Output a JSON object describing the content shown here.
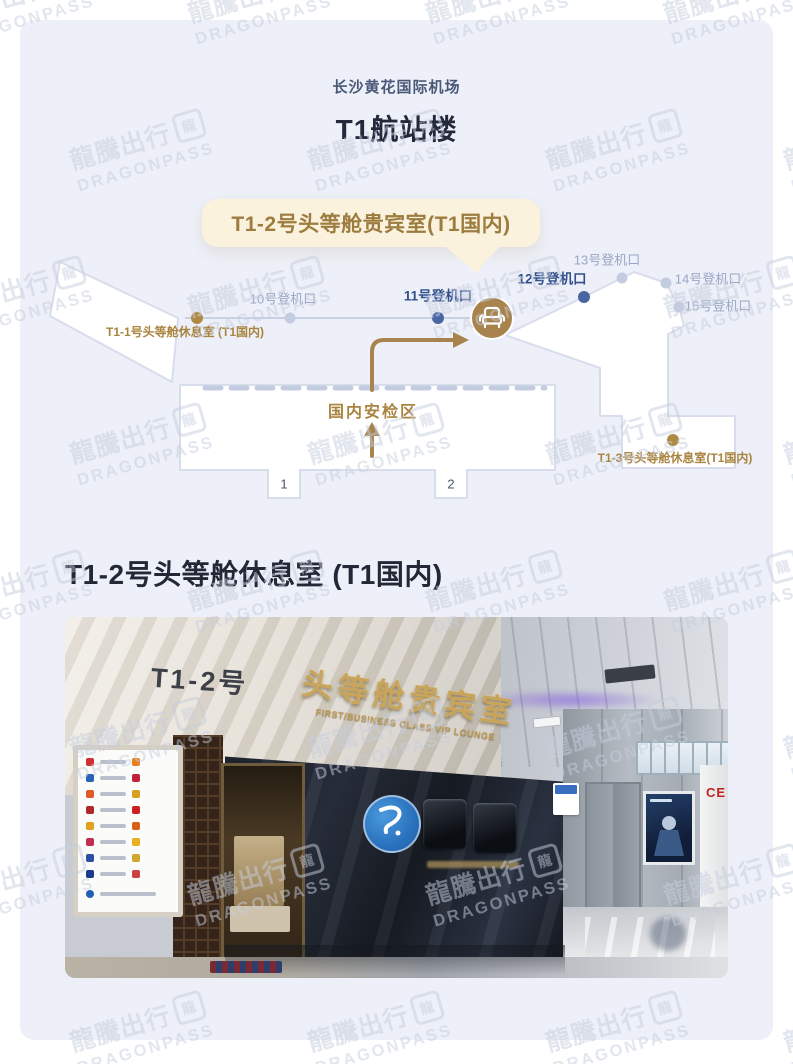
{
  "watermark": {
    "cn": "龍騰出行",
    "en": "DRAGONPASS",
    "logo_char": "龍"
  },
  "header": {
    "airport": "长沙黄花国际机场",
    "terminal": "T1航站楼"
  },
  "map": {
    "callout_label": "T1-2号头等舱贵宾室(T1国内)",
    "security_label": "国内安检区",
    "doors": [
      "1",
      "2"
    ],
    "gates": [
      {
        "label": "10号登机口",
        "state": "default"
      },
      {
        "label": "11号登机口",
        "state": "highlight"
      },
      {
        "label": "12号登机口",
        "state": "highlight"
      },
      {
        "label": "13号登机口",
        "state": "default"
      },
      {
        "label": "14号登机口",
        "state": "default"
      },
      {
        "label": "15号登机口",
        "state": "default"
      }
    ],
    "lounges": [
      {
        "label": "T1-1号头等舱休息室 (T1国内)"
      },
      {
        "label": "T1-3号头等舱休息室(T1国内)"
      }
    ],
    "colors": {
      "card_bg": "#EDF0F8",
      "terminal_fill": "#FFFFFF",
      "terminal_stroke": "#D8DDEB",
      "accent_gold": "#A8834E",
      "gold_text": "#A9843F",
      "gate_highlight_text": "#33508C",
      "gate_default_text": "#9AA6C6",
      "dot_highlight": "#4A66A0",
      "dot_default": "#C3CCE1",
      "callout_bg": "#FBF2DE",
      "callout_text": "#9C7C3F",
      "dashed_line": "#C2CBDF"
    }
  },
  "section": {
    "title": "T1-2号头等舱休息室 (T1国内)"
  },
  "photo": {
    "room_sign": "T1-2号",
    "lounge_sign_cn": "头等舱贵宾室",
    "lounge_sign_en": "FIRST/BUSINESS CLASS VIP LOUNGE",
    "pillar_sign": "CE"
  }
}
